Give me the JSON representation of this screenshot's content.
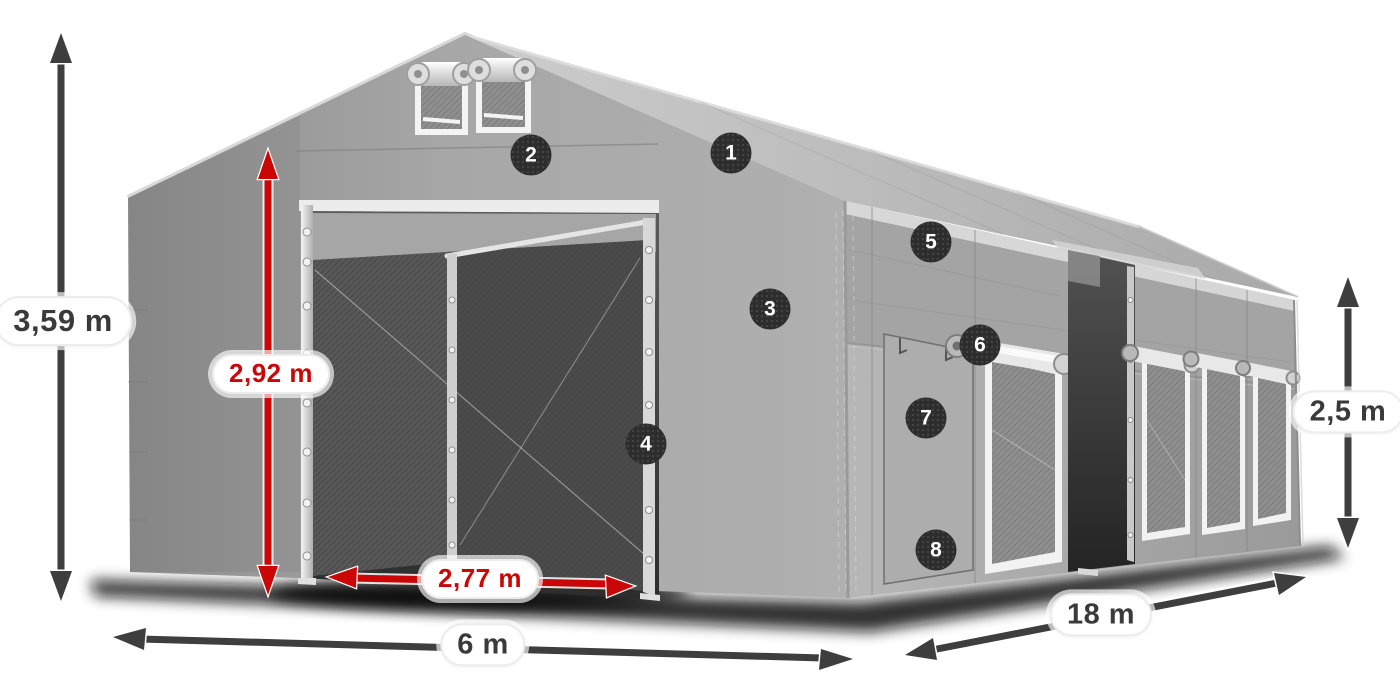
{
  "diagram": {
    "kind": "tent-dimension-diagram",
    "colors": {
      "accent_red": "#cb0606",
      "dimension_gray": "#3e3e3e",
      "badge_bg": "#2d2d2d",
      "badge_text": "#ffffff",
      "pill_bg": "#ffffff",
      "tent_gray": "#a8a8a8"
    }
  },
  "dimensions": {
    "total_height": {
      "label": "3,59 m",
      "color": "gray"
    },
    "door_height": {
      "label": "2,92 m",
      "color": "red"
    },
    "door_width": {
      "label": "2,77 m",
      "color": "red"
    },
    "width": {
      "label": "6 m",
      "color": "gray"
    },
    "length": {
      "label": "18 m",
      "color": "gray"
    },
    "side_height": {
      "label": "2,5 m",
      "color": "gray"
    }
  },
  "callouts": [
    {
      "number": "1"
    },
    {
      "number": "2"
    },
    {
      "number": "3"
    },
    {
      "number": "4"
    },
    {
      "number": "5"
    },
    {
      "number": "6"
    },
    {
      "number": "7"
    },
    {
      "number": "8"
    }
  ]
}
